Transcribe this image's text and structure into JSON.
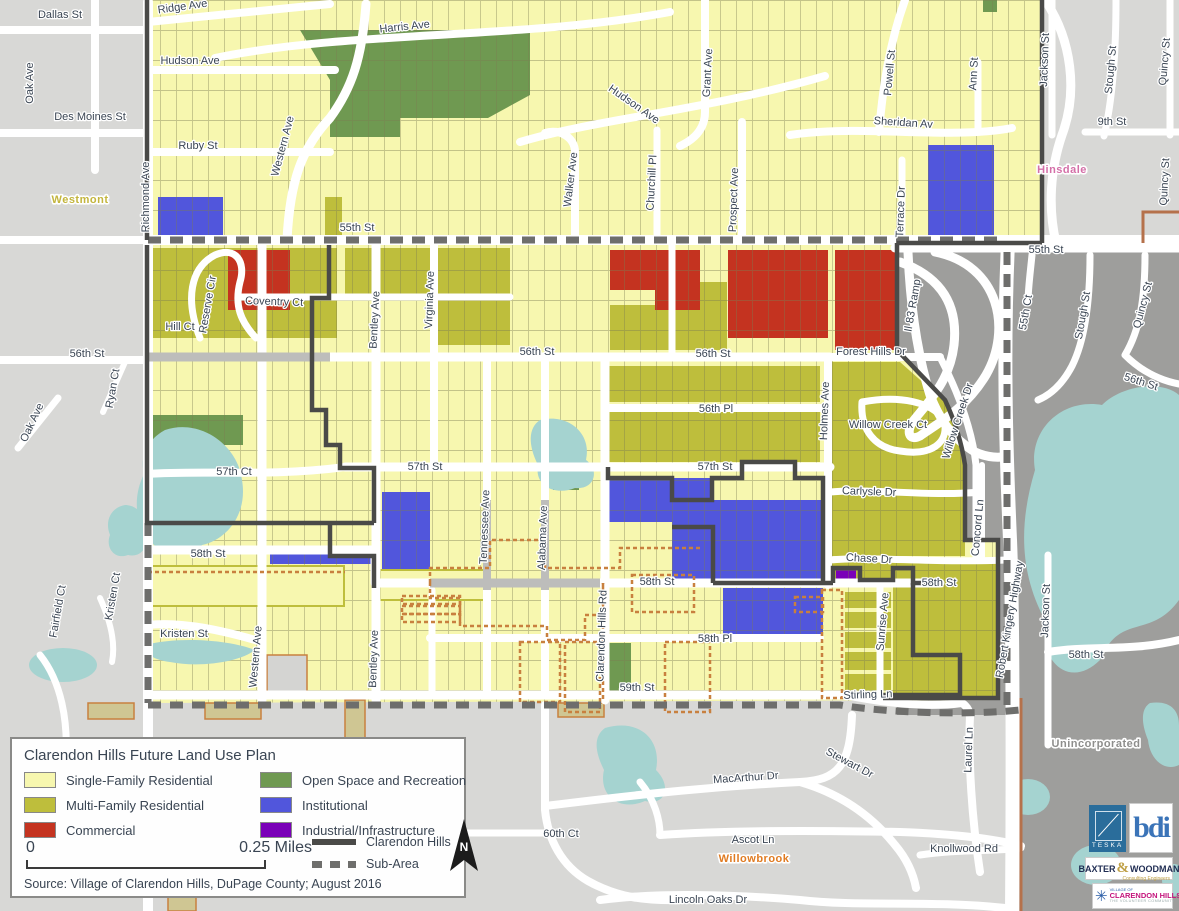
{
  "colors": {
    "single": "#F7F7AF",
    "multi": "#BEBE3C",
    "commercial": "#C43320",
    "open": "#6F9951",
    "institutional": "#5156DC",
    "industrial": "#7A00B8",
    "water": "#A5D3D0",
    "bg_light": "#D8D8D6",
    "bg_dark": "#9E9E9C",
    "road": "#FFFFFF",
    "boundary": "#4A4A48",
    "subarea": "#6E6E6C",
    "orange": "#C8803F",
    "brown": "#B5714B",
    "westmont": "#C3B53D",
    "hinsdale": "#D46FA8",
    "willowbrook": "#E07B22",
    "unincorporated": "#8E8E8C"
  },
  "map": {
    "street_labels": [
      {
        "t": "Dallas St",
        "x": 60,
        "y": 18
      },
      {
        "t": "Oak Ave",
        "x": 33,
        "y": 83,
        "r": -90
      },
      {
        "t": "Des Moines St",
        "x": 90,
        "y": 120
      },
      {
        "t": "Ridge Ave",
        "x": 183,
        "y": 10,
        "r": -8
      },
      {
        "t": "Hudson Ave",
        "x": 190,
        "y": 64
      },
      {
        "t": "Ruby St",
        "x": 198,
        "y": 149
      },
      {
        "t": "Harris Ave",
        "x": 405,
        "y": 30,
        "r": -6
      },
      {
        "t": "Western Ave",
        "x": 286,
        "y": 147,
        "r": -75
      },
      {
        "t": "Hudson Ave",
        "x": 632,
        "y": 107,
        "r": 35
      },
      {
        "t": "Walker Ave",
        "x": 574,
        "y": 180,
        "r": -83
      },
      {
        "t": "Churchill Pl",
        "x": 655,
        "y": 183,
        "r": -87
      },
      {
        "t": "Grant Ave",
        "x": 711,
        "y": 73,
        "r": -87
      },
      {
        "t": "Prospect Ave",
        "x": 737,
        "y": 200,
        "r": -88
      },
      {
        "t": "Powell St",
        "x": 893,
        "y": 73,
        "r": -85
      },
      {
        "t": "Ann St",
        "x": 977,
        "y": 74,
        "r": -87
      },
      {
        "t": "Sheridan Av",
        "x": 903,
        "y": 126,
        "r": 4
      },
      {
        "t": "Terrace Dr",
        "x": 904,
        "y": 212,
        "r": -88
      },
      {
        "t": "55th St",
        "x": 357,
        "y": 231
      },
      {
        "t": "55th St",
        "x": 1046,
        "y": 253
      },
      {
        "t": "Jackson St",
        "x": 1048,
        "y": 60,
        "r": -88
      },
      {
        "t": "Stough St",
        "x": 1114,
        "y": 70,
        "r": -85
      },
      {
        "t": "Quincy St",
        "x": 1168,
        "y": 62,
        "r": -85
      },
      {
        "t": "9th St",
        "x": 1112,
        "y": 125
      },
      {
        "t": "Quincy St",
        "x": 1168,
        "y": 182,
        "r": -87
      },
      {
        "t": "Richmond Ave",
        "x": 149,
        "y": 197,
        "r": -90
      },
      {
        "t": "56th St",
        "x": 87,
        "y": 357
      },
      {
        "t": "Oak Ave",
        "x": 35,
        "y": 424,
        "r": -65
      },
      {
        "t": "Ryan Ct",
        "x": 116,
        "y": 389,
        "r": -80
      },
      {
        "t": "Reserve Cir",
        "x": 211,
        "y": 305,
        "r": -80
      },
      {
        "t": "Hill Ct",
        "x": 180,
        "y": 330
      },
      {
        "t": "Coventry Ct",
        "x": 274,
        "y": 305,
        "r": 2
      },
      {
        "t": "Bentley Ave",
        "x": 378,
        "y": 320,
        "r": -87
      },
      {
        "t": "Virginia Ave",
        "x": 433,
        "y": 300,
        "r": -88
      },
      {
        "t": "56th St",
        "x": 537,
        "y": 355
      },
      {
        "t": "56th St",
        "x": 713,
        "y": 357
      },
      {
        "t": "Forest Hills Dr",
        "x": 871,
        "y": 355
      },
      {
        "t": "Il 83 Ramp",
        "x": 916,
        "y": 306,
        "r": -80
      },
      {
        "t": "56th Pl",
        "x": 716,
        "y": 412
      },
      {
        "t": "Holmes Ave",
        "x": 828,
        "y": 411,
        "r": -88
      },
      {
        "t": "Willow Creek Ct",
        "x": 888,
        "y": 428
      },
      {
        "t": "Willow Creek Dr",
        "x": 961,
        "y": 422,
        "r": -72
      },
      {
        "t": "57th St",
        "x": 425,
        "y": 470
      },
      {
        "t": "57th St",
        "x": 715,
        "y": 470
      },
      {
        "t": "57th Ct",
        "x": 234,
        "y": 475
      },
      {
        "t": "Carlysle Dr",
        "x": 869,
        "y": 495,
        "r": 2
      },
      {
        "t": "Tennessee Ave",
        "x": 488,
        "y": 527,
        "r": -88
      },
      {
        "t": "Alabama Ave",
        "x": 546,
        "y": 538,
        "r": -88
      },
      {
        "t": "Concord Ln",
        "x": 981,
        "y": 528,
        "r": -85
      },
      {
        "t": "55th Ct",
        "x": 1029,
        "y": 313,
        "r": -80
      },
      {
        "t": "Stough St",
        "x": 1086,
        "y": 316,
        "r": -80
      },
      {
        "t": "Quincy St",
        "x": 1146,
        "y": 306,
        "r": -75
      },
      {
        "t": "56th St",
        "x": 1140,
        "y": 385,
        "r": 18
      },
      {
        "t": "58th St",
        "x": 208,
        "y": 557
      },
      {
        "t": "Chase Dr",
        "x": 869,
        "y": 562,
        "r": 3
      },
      {
        "t": "58th St",
        "x": 657,
        "y": 585
      },
      {
        "t": "58th St",
        "x": 939,
        "y": 586
      },
      {
        "t": "Kristen Ct",
        "x": 116,
        "y": 597,
        "r": -80
      },
      {
        "t": "Fairfield Ct",
        "x": 61,
        "y": 612,
        "r": -80
      },
      {
        "t": "Kristen St",
        "x": 184,
        "y": 637
      },
      {
        "t": "Western Ave",
        "x": 259,
        "y": 657,
        "r": -85
      },
      {
        "t": "Bentley Ave",
        "x": 377,
        "y": 659,
        "r": -88
      },
      {
        "t": "Clarendon Hills Rd",
        "x": 605,
        "y": 636,
        "r": -88
      },
      {
        "t": "58th Pl",
        "x": 715,
        "y": 642
      },
      {
        "t": "Sunrise Ave",
        "x": 886,
        "y": 622,
        "r": -85
      },
      {
        "t": "Robert Kingery Highway",
        "x": 1013,
        "y": 620,
        "r": -80
      },
      {
        "t": "Jackson St",
        "x": 1049,
        "y": 611,
        "r": -88
      },
      {
        "t": "58th St",
        "x": 1086,
        "y": 658
      },
      {
        "t": "59th St",
        "x": 637,
        "y": 691
      },
      {
        "t": "Stirling Ln",
        "x": 868,
        "y": 698,
        "r": -2
      },
      {
        "t": "Laurel Ln",
        "x": 972,
        "y": 750,
        "r": -88
      },
      {
        "t": "MacArthur Dr",
        "x": 746,
        "y": 781,
        "r": -4
      },
      {
        "t": "Stewart Dr",
        "x": 848,
        "y": 766,
        "r": 28
      },
      {
        "t": "Ascot Ln",
        "x": 753,
        "y": 843
      },
      {
        "t": "60th Ct",
        "x": 561,
        "y": 837
      },
      {
        "t": "Knollwood Rd",
        "x": 964,
        "y": 852
      },
      {
        "t": "Lincoln Oaks Dr",
        "x": 708,
        "y": 903
      },
      {
        "t": "Westmont",
        "x": 80,
        "y": 203,
        "c": "place",
        "f": "westmont",
        "s": 19
      },
      {
        "t": "Hinsdale",
        "x": 1062,
        "y": 173,
        "c": "place",
        "f": "hinsdale",
        "s": 19
      },
      {
        "t": "Unincorporated",
        "x": 1096,
        "y": 747,
        "c": "place",
        "f": "unincorporated",
        "s": 18
      },
      {
        "t": "Willowbrook",
        "x": 754,
        "y": 862,
        "c": "place",
        "f": "willowbrook",
        "s": 18
      }
    ]
  },
  "legend": {
    "title": "Clarendon Hills Future Land Use Plan",
    "columns": [
      [
        {
          "label": "Single-Family Residential",
          "key": "single"
        },
        {
          "label": "Multi-Family Residential",
          "key": "multi"
        },
        {
          "label": "Commercial",
          "key": "commercial"
        }
      ],
      [
        {
          "label": "Open Space and Recreation",
          "key": "open"
        },
        {
          "label": "Institutional",
          "key": "institutional"
        },
        {
          "label": "Industrial/Infrastructure",
          "key": "industrial"
        }
      ]
    ],
    "lines": [
      {
        "label": "Clarendon Hills",
        "style": "solid"
      },
      {
        "label": "Sub-Area",
        "style": "dashed"
      }
    ],
    "scale": {
      "start": "0",
      "end": "0.25 Miles"
    },
    "north": "N",
    "source": "Source: Village of Clarendon Hills, DuPage County; August 2016"
  },
  "logos": {
    "teska": "TESKA",
    "bdi": "bdi",
    "baxter_1": "BAXTER",
    "baxter_amp": "&",
    "baxter_2": "WOODMAN",
    "baxter_sub": "Consulting Engineers",
    "village_top": "VILLAGE OF",
    "village_name": "CLARENDON HILLS",
    "village_sub": "THE VOLUNTEER COMMUNITY",
    "village_star": "✳"
  }
}
